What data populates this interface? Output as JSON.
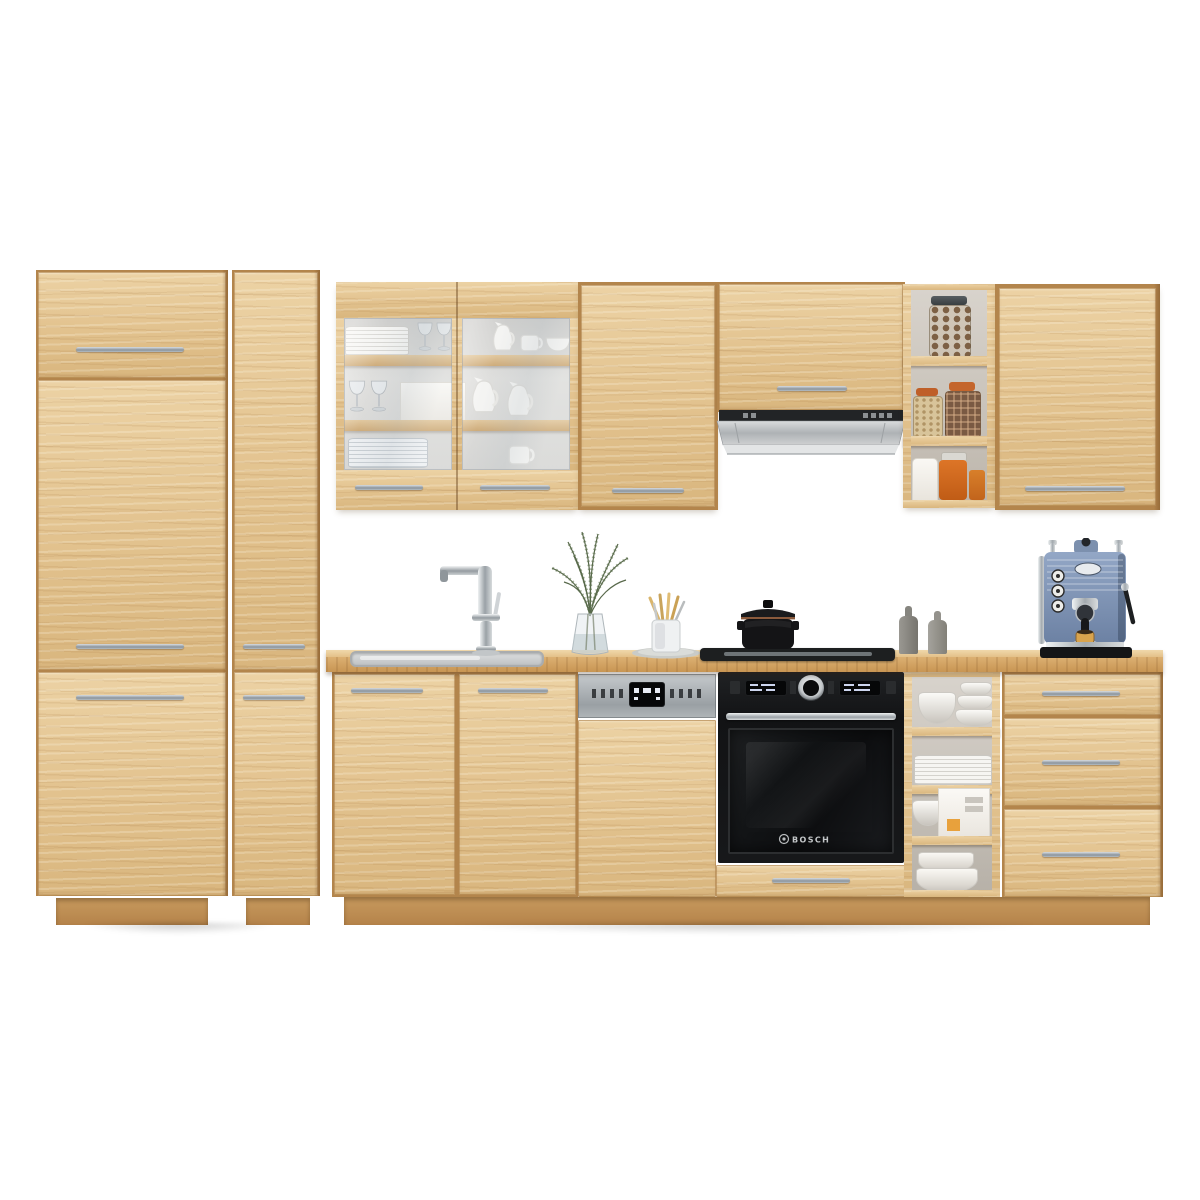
{
  "scene": {
    "type": "product-photo",
    "subject": "modular kitchen cabinet set",
    "finish": "artisan oak",
    "background": "#ffffff"
  },
  "palette": {
    "wood_light": "#ecd2a4",
    "wood_mid": "#e2c28e",
    "wood_shadow": "#d9b67e",
    "carcass": "#b3854c",
    "counter_front": "#c89553",
    "handle_steel": "#9aa3ab",
    "appliance_black": "#17181a",
    "steel": "#b6babd",
    "espresso_blue": "#7e92b4",
    "jar_orange": "#c4652c",
    "foliage_green": "#57684a"
  },
  "appliances": {
    "oven": {
      "brand_label": "BOSCH",
      "color": "black glass"
    },
    "dishwasher": {
      "style": "semi-integrated control strip"
    },
    "hood": {
      "style": "telescopic pull-out"
    },
    "hob": {
      "style": "built-in surface"
    },
    "espresso_machine": {
      "color": "slate blue"
    }
  },
  "furniture": {
    "tall_units": [
      "larder-two-door",
      "larder-narrow"
    ],
    "wall_units": [
      "glass-display-double",
      "single-door",
      "hood-housing",
      "open-shelf-jars",
      "single-door-wide"
    ],
    "base_units": [
      "double-door-sink",
      "dishwasher-panel",
      "oven-housing-with-drawer",
      "open-shelf-dishes",
      "three-drawer"
    ]
  },
  "props": {
    "glass_cabinet": [
      "stacked plates",
      "wine glasses",
      "white jugs",
      "cups and bowls"
    ],
    "open_shelf_top": [
      "glass jar of walnuts",
      "spice jars with orange lids",
      "white canister",
      "orange jars"
    ],
    "open_shelf_bottom": [
      "white bowls",
      "stacked plates",
      "bowl and paper box",
      "stacked casserole dishes"
    ],
    "countertop": [
      "inset sink",
      "chrome mixer tap",
      "green sprigs in glass vase",
      "wooden utensils in holder",
      "grey serving plate",
      "black cast-iron pot",
      "two grey bottles",
      "espresso machine"
    ]
  }
}
